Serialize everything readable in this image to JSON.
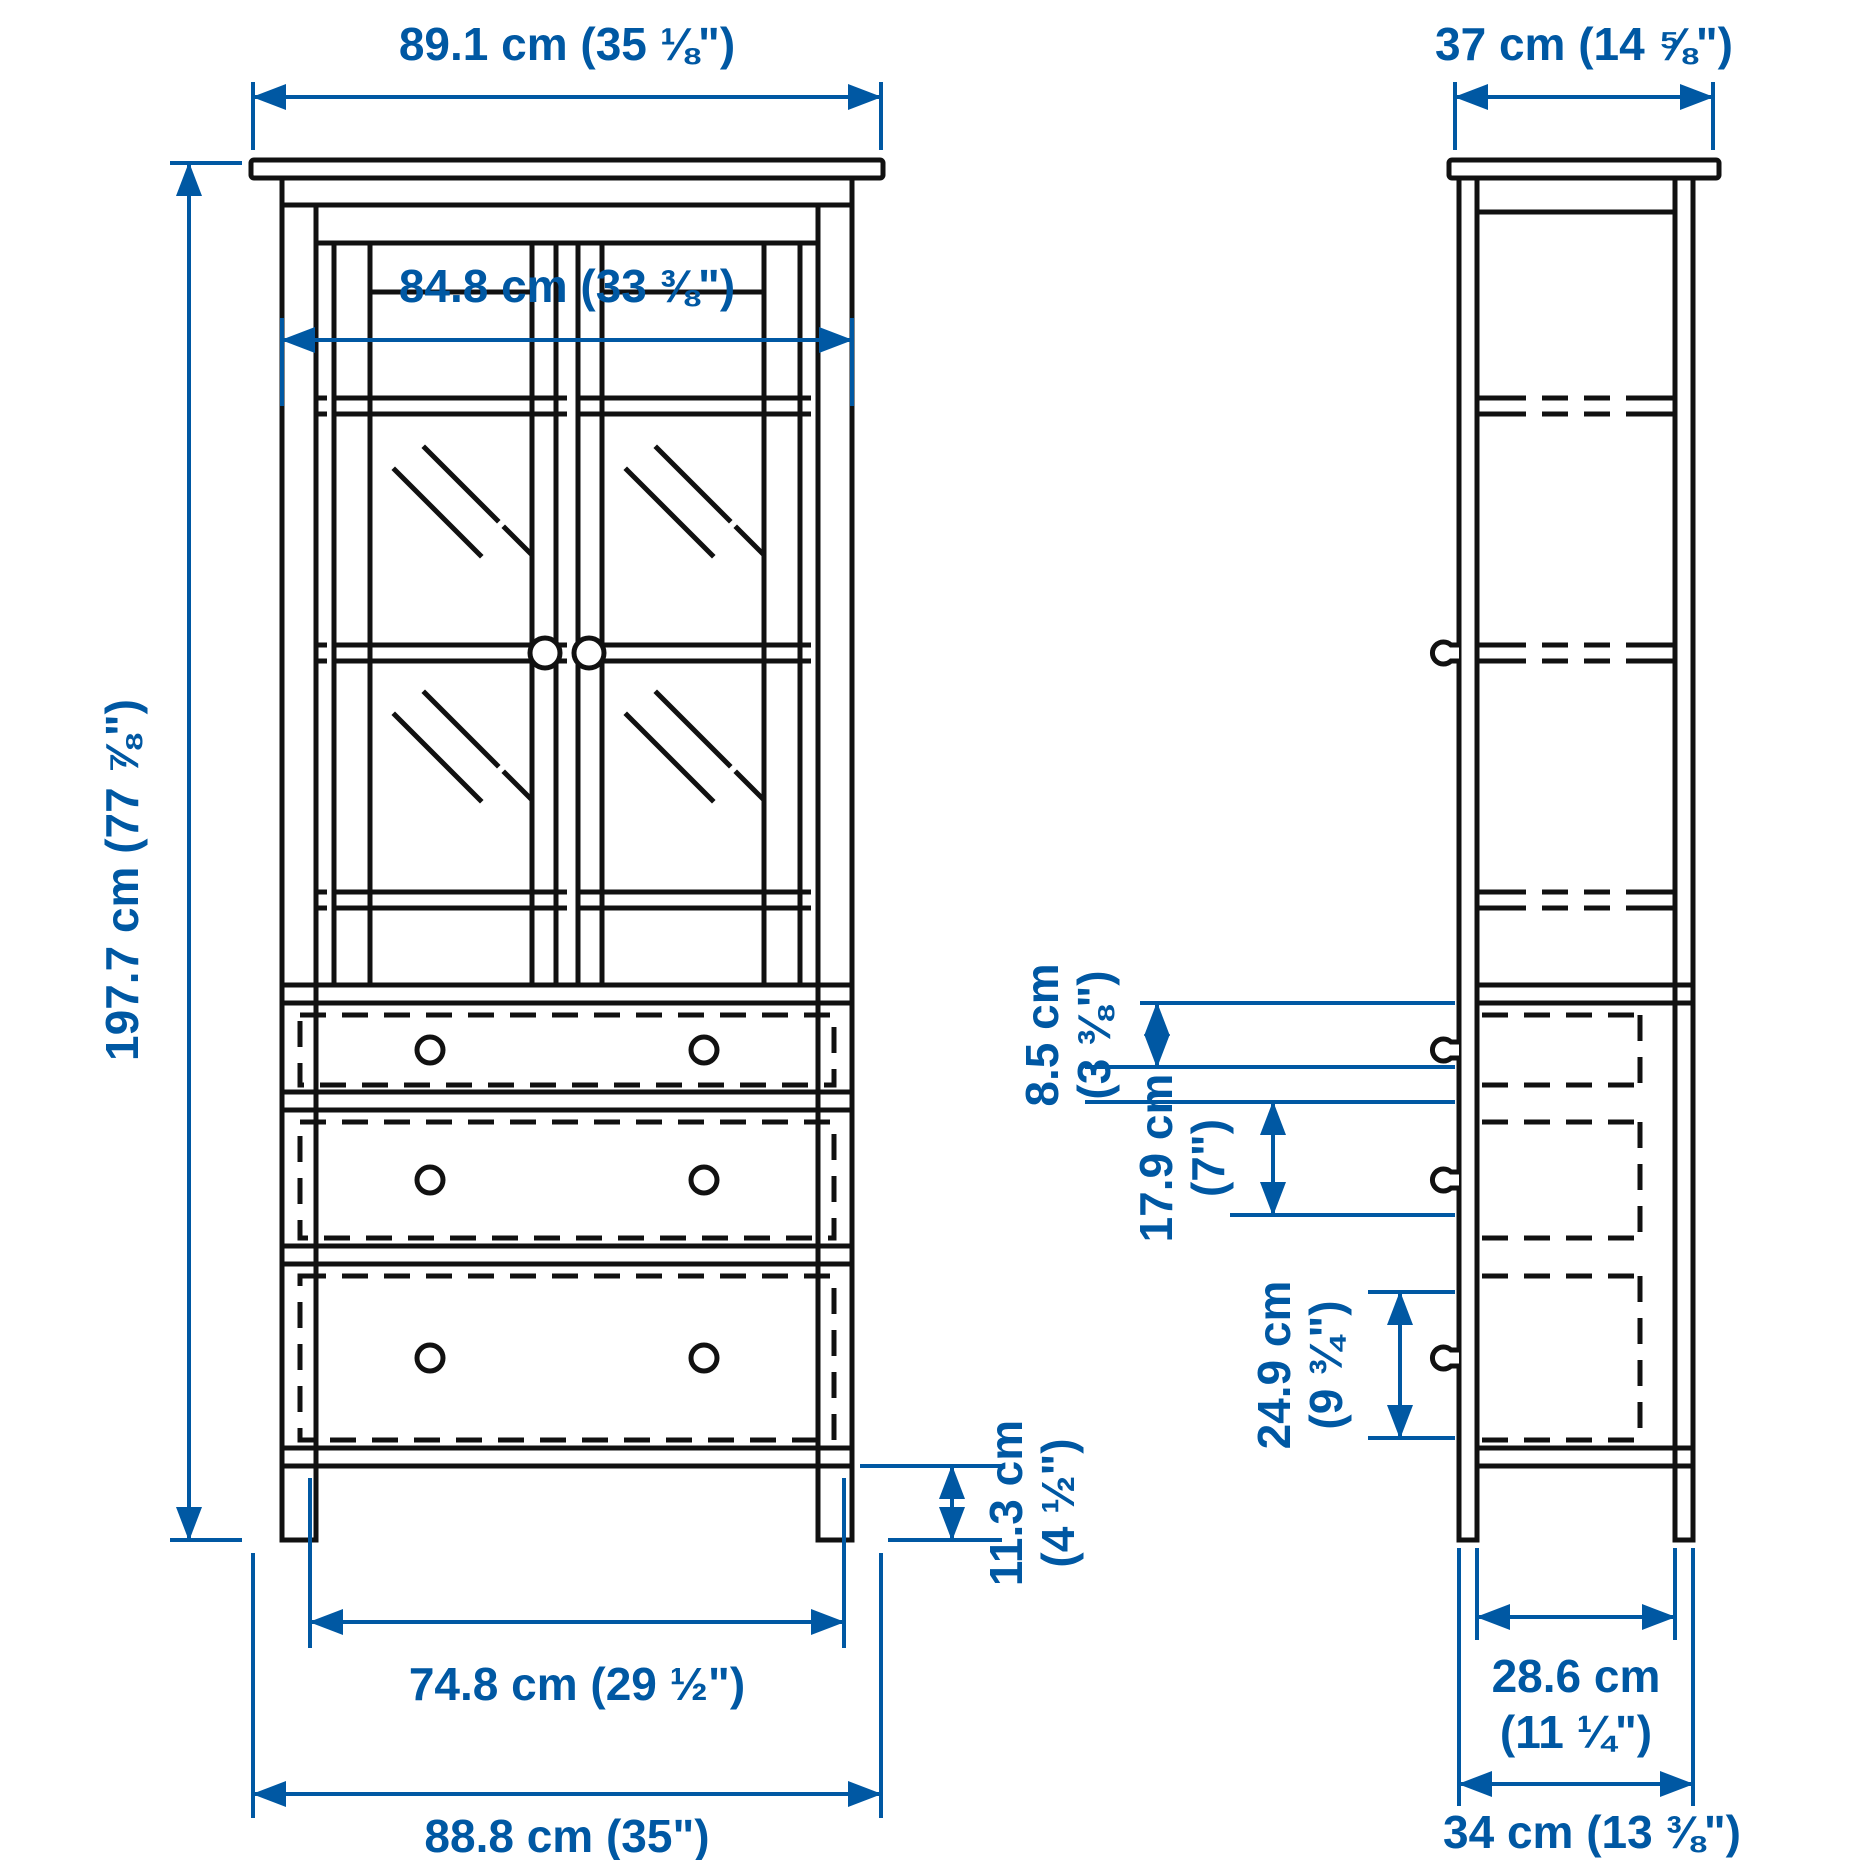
{
  "diagram": {
    "type": "furniture-dimension-drawing",
    "views": [
      {
        "id": "front",
        "description": "glass-door cabinet front elevation with 2 glass doors and 3 drawers"
      },
      {
        "id": "side",
        "description": "cabinet side elevation with shelf and drawer depth lines"
      }
    ]
  },
  "colors": {
    "dimension_blue": "#0058a3",
    "line_black": "#111111",
    "background": "#ffffff"
  },
  "dimensions": {
    "outer_width": {
      "label": "89.1 cm (35 ⅛\")"
    },
    "inner_width": {
      "label": "84.8 cm (33 ⅜\")"
    },
    "height": {
      "label": "197.7 cm (77 ⅞\")"
    },
    "drawer_width": {
      "label": "74.8 cm (29 ½\")"
    },
    "base_width": {
      "label": "88.8 cm (35\")"
    },
    "leg_height": {
      "lines": [
        "11.3 cm",
        "(4 ½\")"
      ]
    },
    "depth_top": {
      "label": "37 cm (14 ⅝\")"
    },
    "drawer1_height": {
      "lines": [
        "8.5 cm",
        "(3 ⅜\")"
      ]
    },
    "drawer2_height": {
      "lines": [
        "17.9 cm",
        "(7\")"
      ]
    },
    "drawer3_height": {
      "lines": [
        "24.9 cm",
        "(9 ¾\")"
      ]
    },
    "drawer_depth": {
      "lines": [
        "28.6 cm",
        "(11 ¼\")"
      ]
    },
    "base_depth": {
      "label": "34 cm (13 ⅜\")"
    }
  }
}
